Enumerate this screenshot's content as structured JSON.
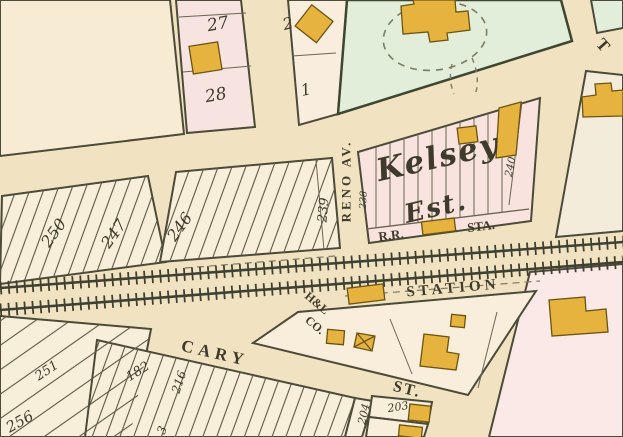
{
  "colors": {
    "bg": "#f1e3c2",
    "cream_block": "#f8efda",
    "pink_block": "#f7e4e0",
    "green_block": "#e2eed9",
    "pale_block": "#f4ecda",
    "building": "#e5b33e",
    "building_stroke": "#6b5413",
    "line": "#4c4a38",
    "rail": "#3e4132",
    "text": "#3f3b2c"
  },
  "streets": {
    "reno_av": "RENO AV.",
    "cary": "CARY",
    "cary_suffix": "ST.",
    "station": "STATION",
    "railroad_sta_prefix": "R.R.",
    "railroad_sta_suffix": "STA.",
    "top_right_partial": "T"
  },
  "estate": {
    "name": "Kelsey",
    "suffix": "Est."
  },
  "company": {
    "line1": "H&L",
    "line2": "CO."
  },
  "lots": {
    "l1": "1",
    "l2": "2",
    "l3": "3",
    "l27": "27",
    "l28": "28",
    "l182": "182",
    "l203": "203",
    "l204": "204",
    "l216": "216",
    "l238": "238",
    "l239": "239",
    "l240": "240",
    "l246": "246",
    "l247": "247",
    "l250": "250",
    "l251": "251",
    "l256": "256"
  }
}
